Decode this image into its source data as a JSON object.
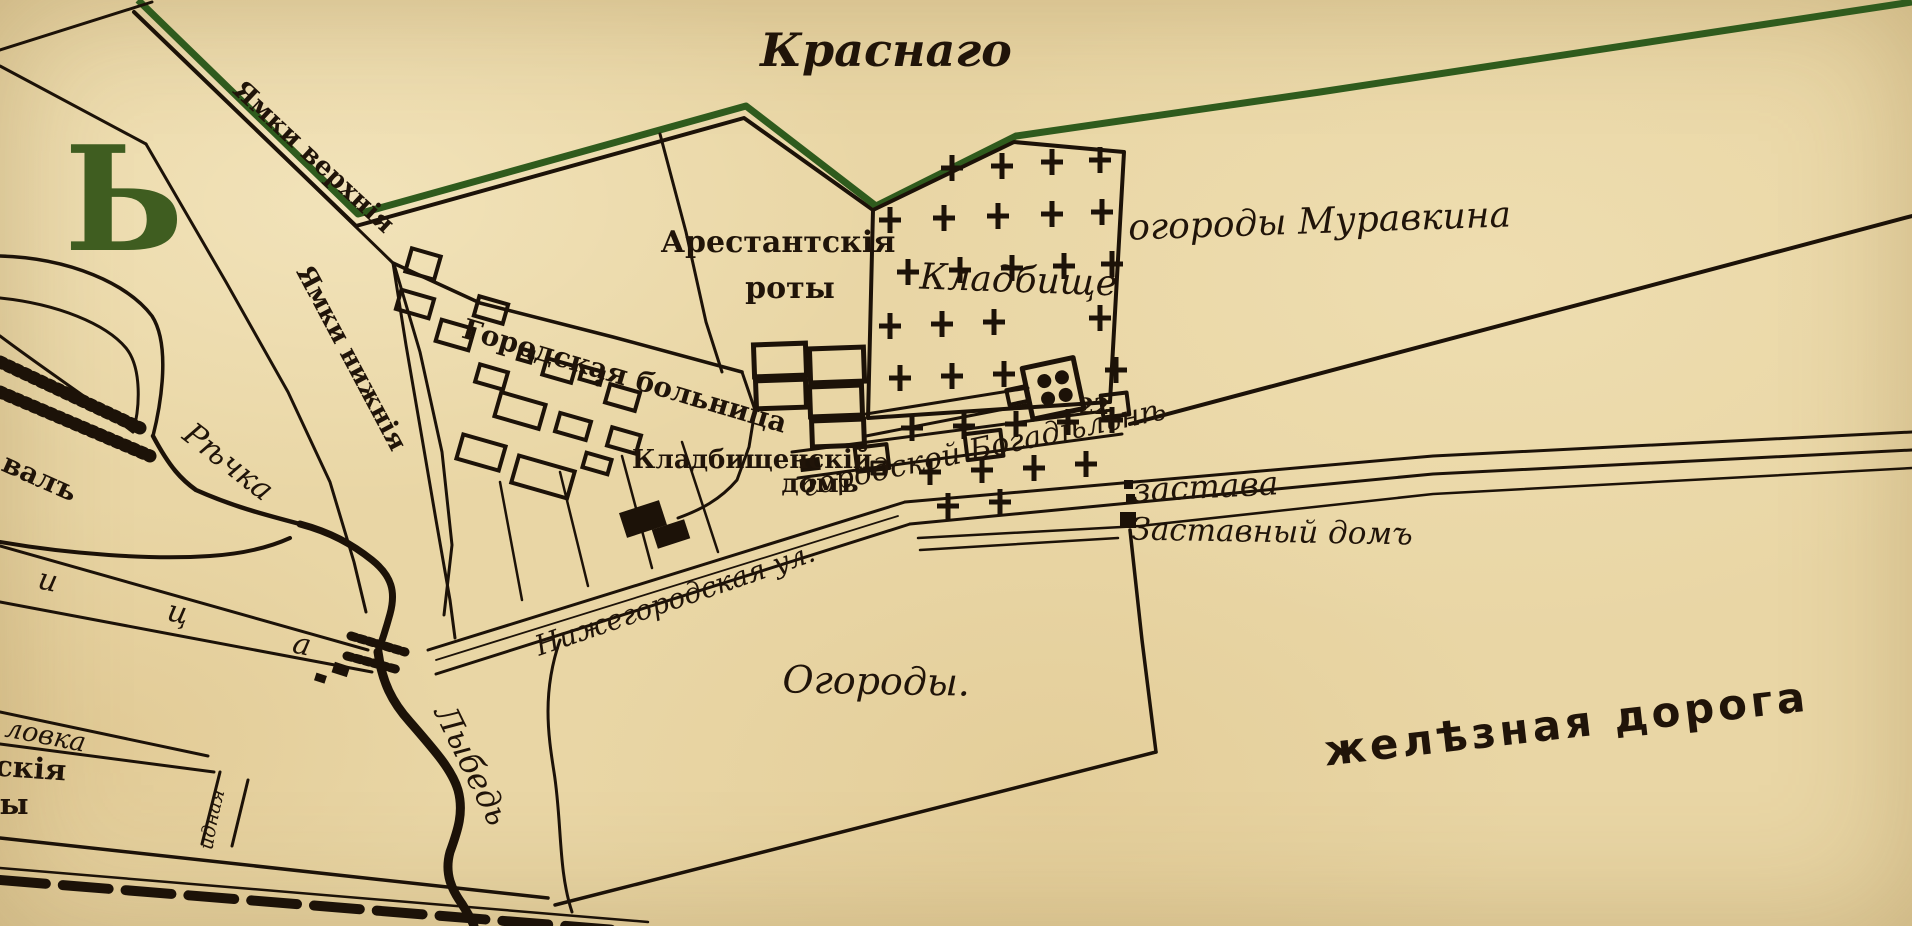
{
  "map": {
    "region_title": "Краснаго",
    "corner_letter": "Ь",
    "streets": {
      "yamki_upper": "Ямки верхнія",
      "yamki_lower": "Ямки нижнія",
      "nizhegorodskaya": "Нижегородская ул.",
      "street_letters": [
        "и",
        "ц",
        "а"
      ],
      "lovka_fragment": "ловка",
      "skiya_fragment": "скія",
      "y_fragment": "ы",
      "invalidnaya": "Инвалидная"
    },
    "water": {
      "rechka": "Рѣчка",
      "lybed": "Лыбедь"
    },
    "features": {
      "val": "валъ",
      "arestantskiya_line1": "Арестантскія",
      "arestantskiya_line2": "роты",
      "hospital": "Городская больница",
      "cemetery": "Кладбище",
      "cemetery_house_line1": "Кладбищенскій",
      "cemetery_house_line2": "домъ",
      "ogorody_muravkina": "огороды Муравкина",
      "doma_road": "Дома  причисленный  къ  городской  Богадѣльнѣ",
      "zastava": "застава",
      "zastavny_dom": "Заставный домъ",
      "ogorody": "Огороды.",
      "railway": "желѣзная дорога",
      "church_number": "22"
    },
    "colors": {
      "paper": "#e9d6a5",
      "ink": "#1c1208",
      "boundary_green": "#2f5b1d",
      "letter_green": "#3f5d20"
    }
  }
}
